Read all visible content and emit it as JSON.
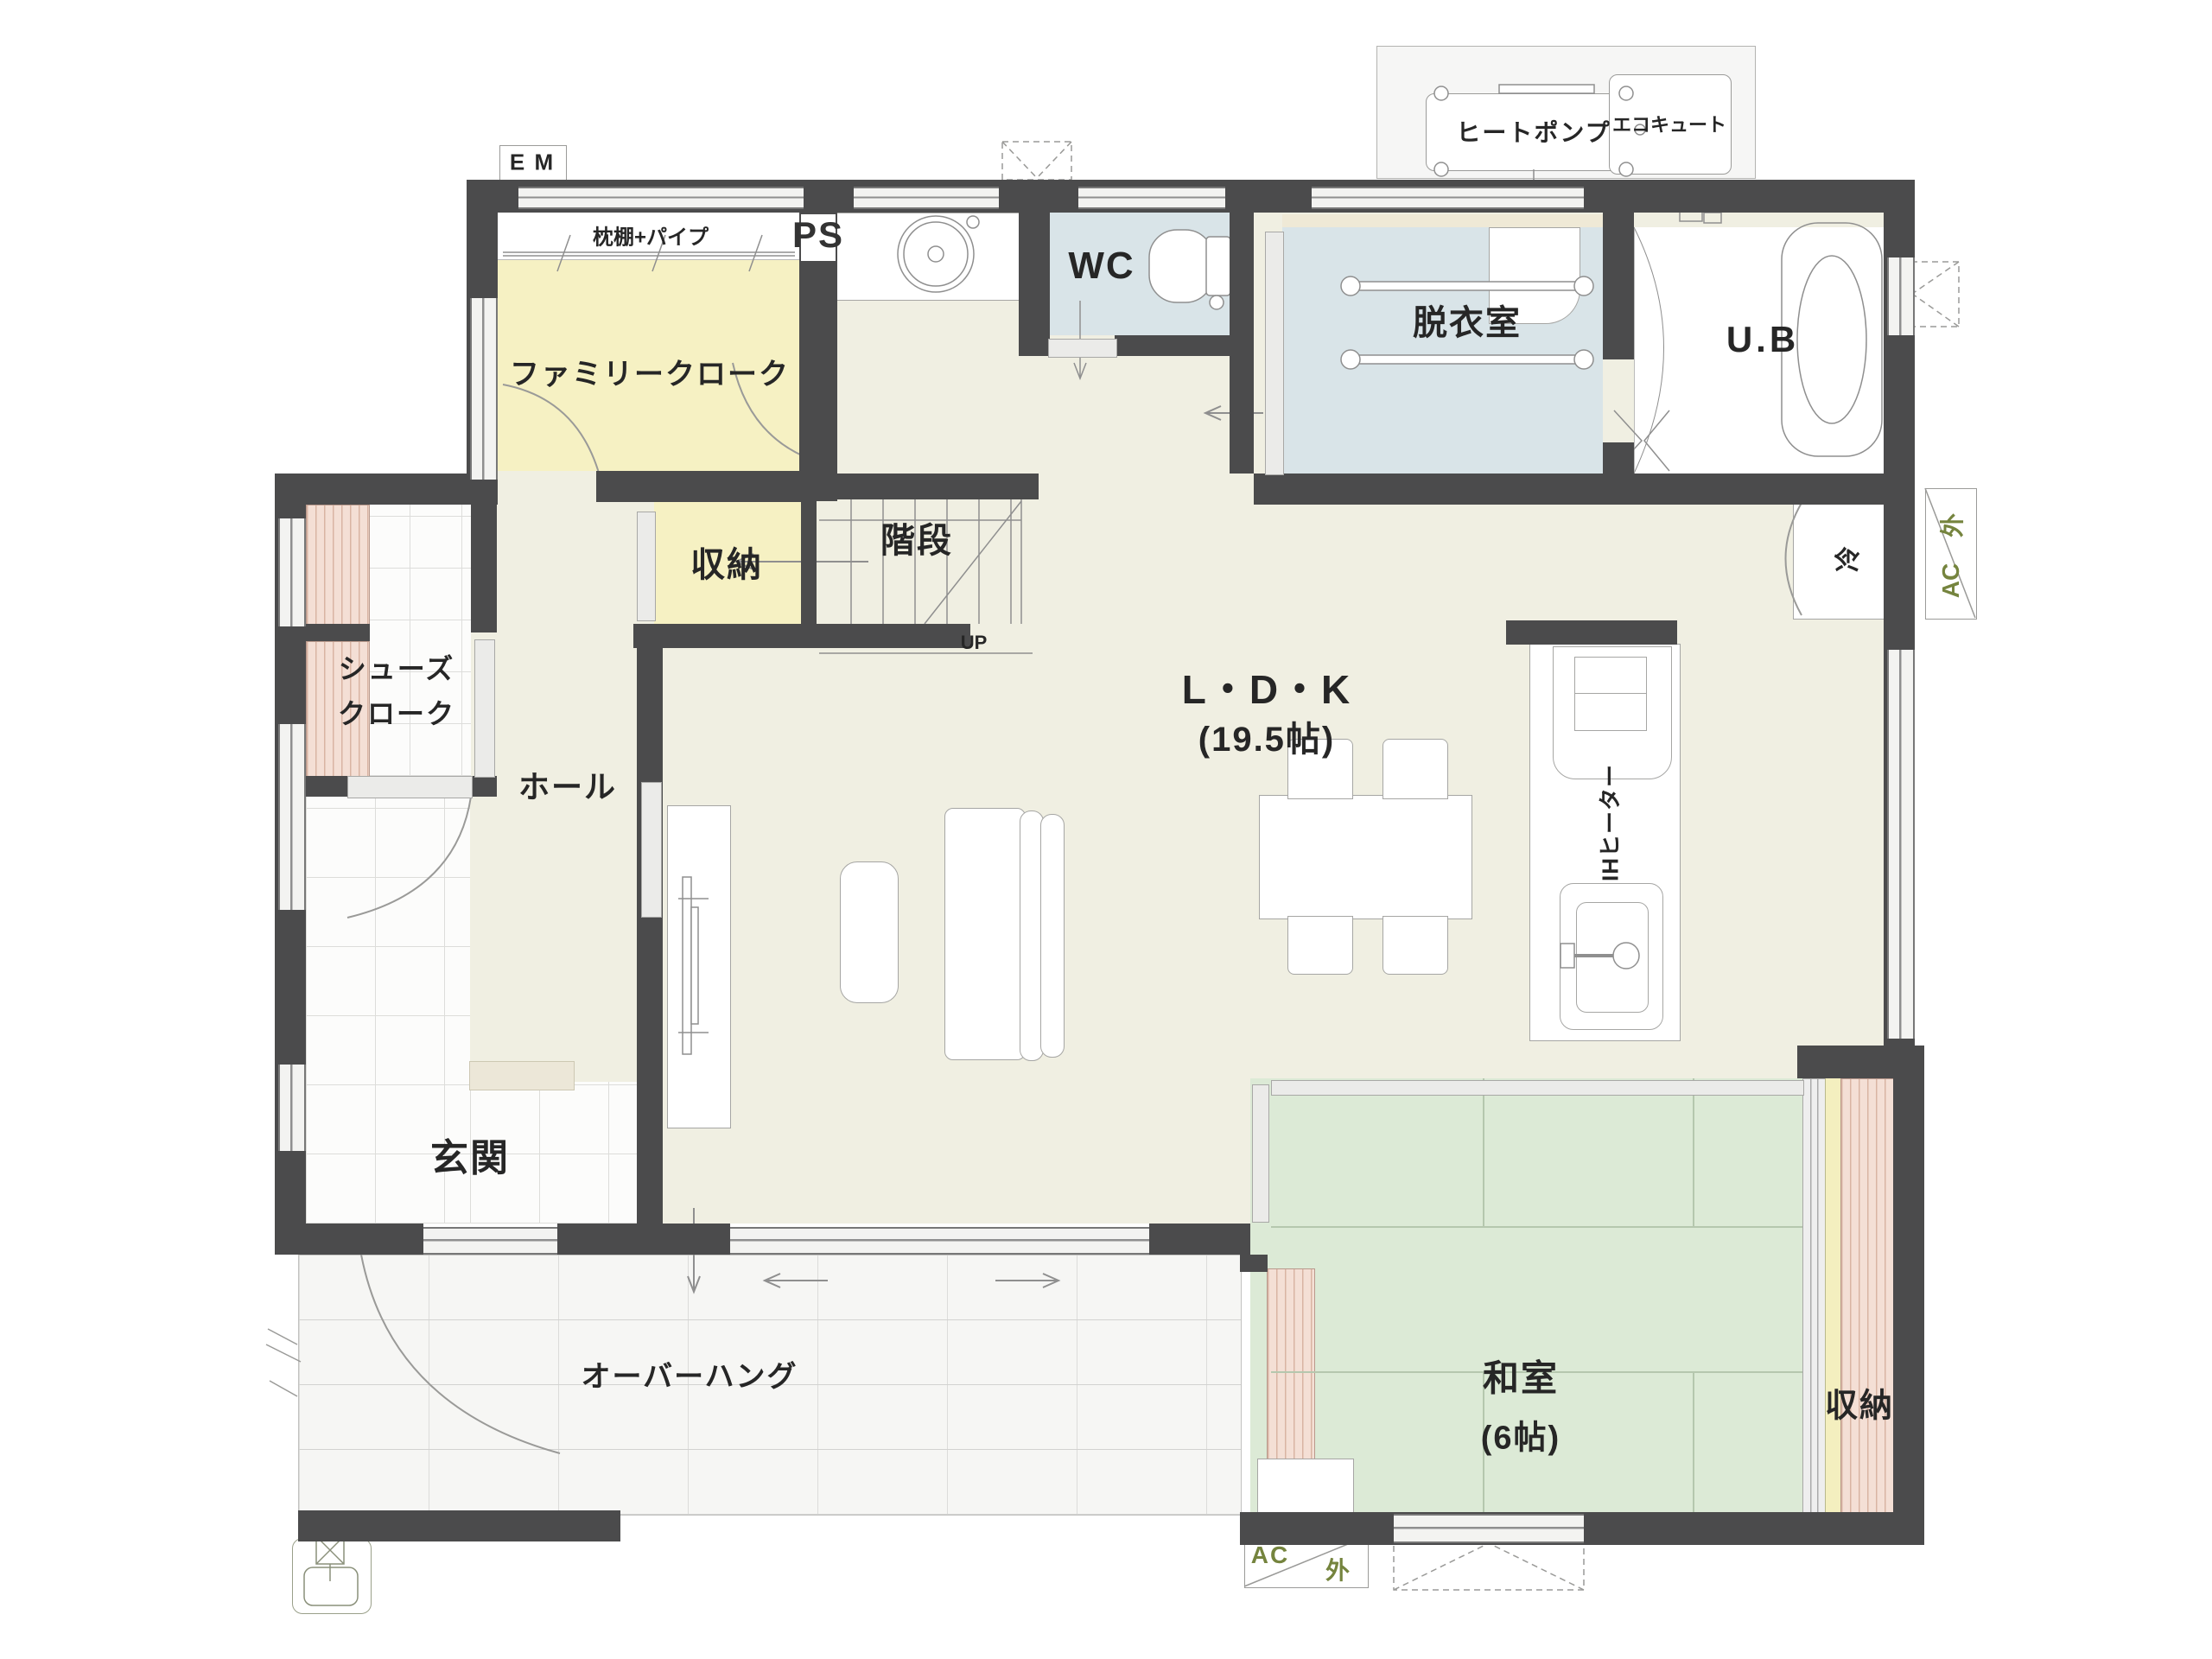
{
  "palette": {
    "wall": "#4b4b4c",
    "floor_cream": "#f0efe2",
    "closet_yellow": "#f6f1c3",
    "wet_blue": "#d9e4e8",
    "tatami_green": "#dcead6",
    "closet_pink": "#f4dfd5",
    "annotation_green": "#75843e",
    "label_dark": "#262626",
    "line_gray": "#8f8f8f"
  },
  "rooms": {
    "family_cloak": {
      "label": "ファミリークローク"
    },
    "closet_mid": {
      "label": "収納"
    },
    "stairs": {
      "label": "階段",
      "up": "UP"
    },
    "wc": {
      "label": "WC"
    },
    "dressing": {
      "label": "脱衣室"
    },
    "bath": {
      "label": "U.B"
    },
    "shoes": {
      "line1": "シューズ",
      "line2": "クローク"
    },
    "hall": {
      "label": "ホール"
    },
    "entrance": {
      "label": "玄関"
    },
    "ldk": {
      "label": "L・D・K",
      "size": "(19.5帖)"
    },
    "washitsu": {
      "label": "和室",
      "size": "(6帖)"
    },
    "closet_right": {
      "label": "収納"
    },
    "overhang": {
      "label": "オーバーハング"
    }
  },
  "equipment": {
    "heat_pump": "ヒートポンプ",
    "ecocute": "エコキュート",
    "em": "E M",
    "ps": "PS",
    "pillow_shelf": "枕棚+パイプ",
    "ih_heater": "IHヒーター",
    "fridge": "冷"
  },
  "annotations": {
    "ac": "AC",
    "outside": "外"
  }
}
